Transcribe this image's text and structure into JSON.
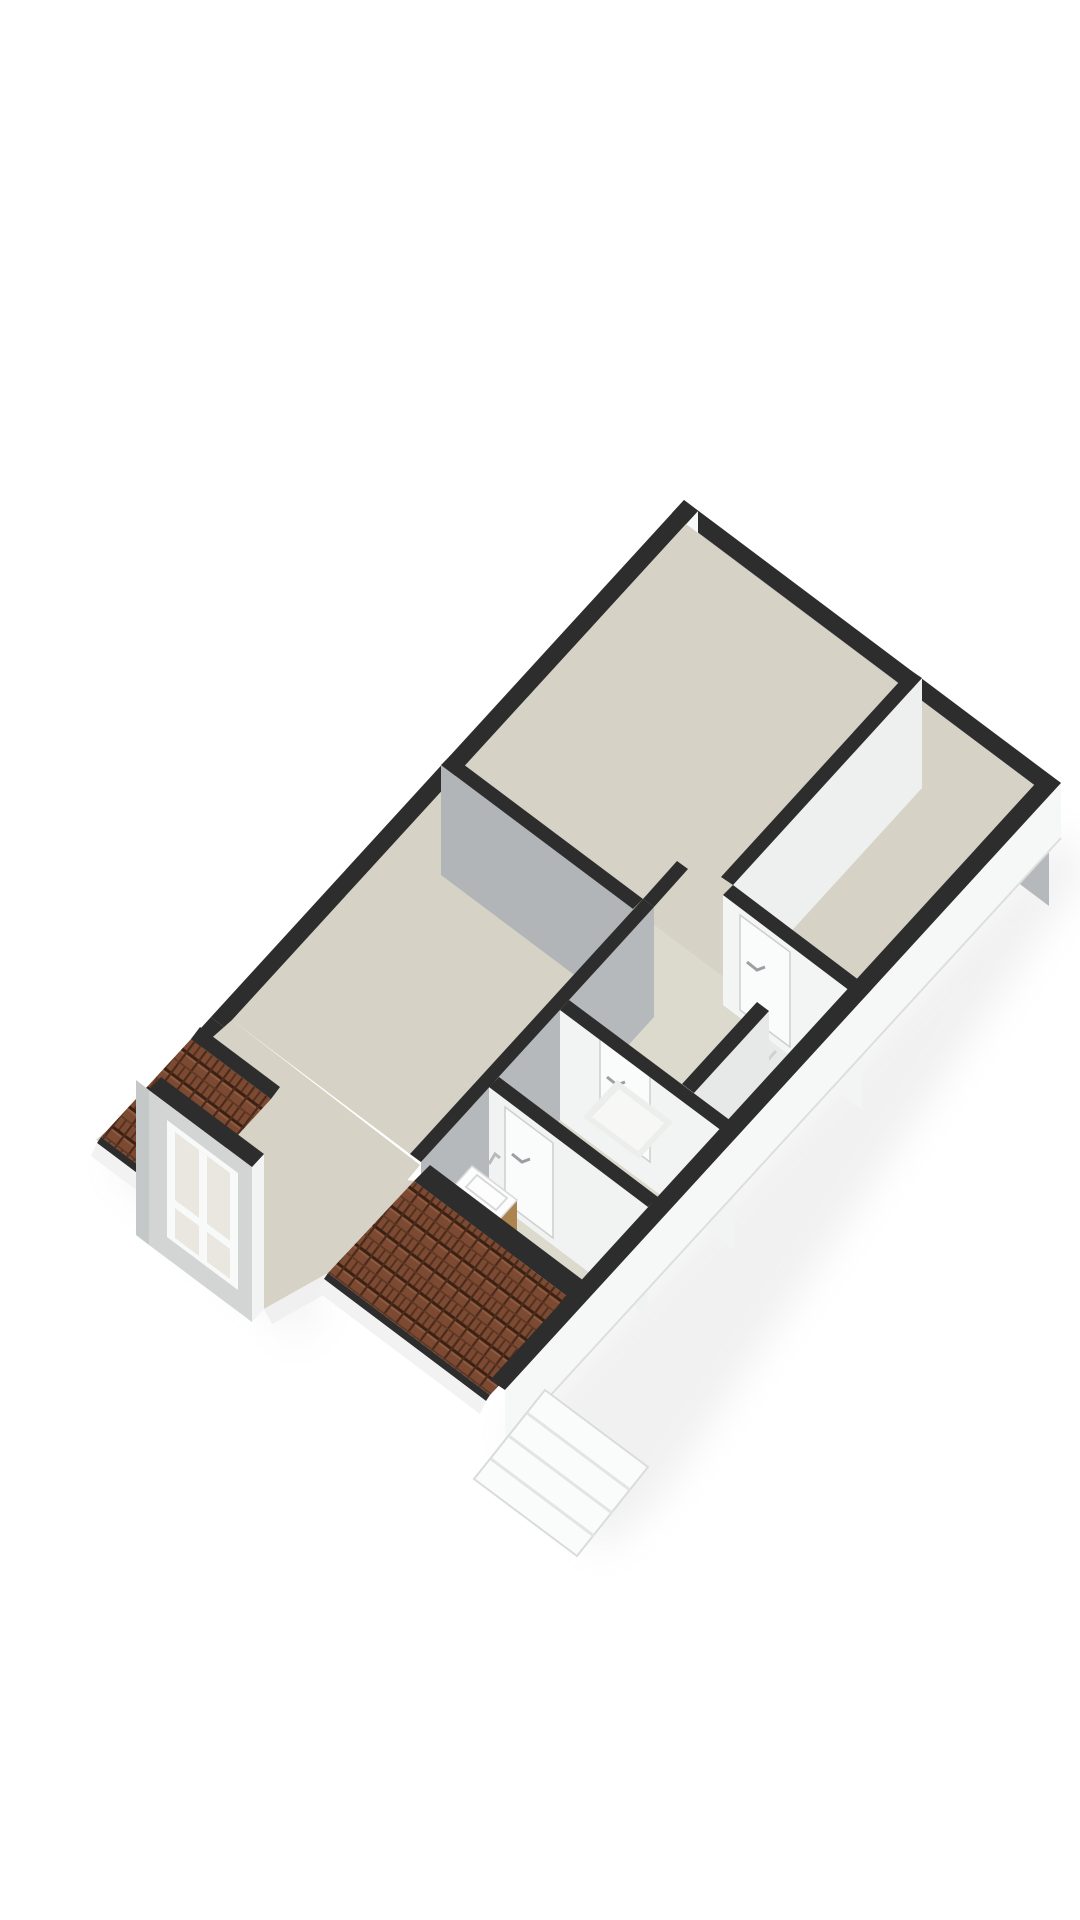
{
  "scene": {
    "type": "3d-floor-plan-render",
    "storey": "attic",
    "visible_features": {
      "exterior_windows_upper_right_wall": 3,
      "window_slots_upper_left_wall": 2,
      "roof_tile_sections": 2,
      "dormer_windows": 1,
      "dormer_window_panes": 4,
      "interior_doors": 3,
      "fixtures": [
        "vanity-with-basin",
        "shower-tray"
      ],
      "stair_bulkhead": 1
    }
  },
  "colors": {
    "bg": "#ffffff",
    "wallDark": "#2d2d2d",
    "wallDarkSoft": "#3a3a3a",
    "neFace": "#b6b9bb",
    "nwFace": "#f7f8f8",
    "seFace": "#f6f7f7",
    "seFaceEdge": "#e9ebeb",
    "wall2Face": "#eef0f0",
    "wall3Face": "#f3f4f4",
    "s1Face": "#b2b5b7",
    "s4Face": "#b6b9bb",
    "s6aFace": "#e7e9e9",
    "s6bFace": "#f2f3f3",
    "bathFace": "#f1f2f2",
    "floor": "#d6d2c5",
    "floorLight": "#dcd9cd",
    "floorCell": "#e8e9e9",
    "kneeStrip": "#eff0ef",
    "frame": "#f8f9f9",
    "glass": "#e9ebe9",
    "glassBright": "#eff1ef",
    "paneCream": "#eae7e0",
    "sill": "#cfd2d1",
    "slotInner": "#e5e7e7",
    "dormerFront": "#d3d5d5",
    "dormerSide": "#c5c8c8",
    "dormerSliver": "#f2f3f3",
    "tileBase": "#7c4a32",
    "tileDark": "#3b2113",
    "tileRib": "#4a2a1a",
    "tileLight": "#8f5b3e",
    "wood": "#c59e63",
    "woodDark": "#ab8450",
    "porcelain": "#fdfdfd",
    "trayOuter": "#eceeec",
    "trayInner": "#f7f8f6",
    "doorLeaf": "#fafbfb",
    "doorEdge": "#cdd0d0",
    "handle": "#9aa0a2",
    "fascia": "#f2f2f2",
    "shadow": "#9b9b9b"
  }
}
